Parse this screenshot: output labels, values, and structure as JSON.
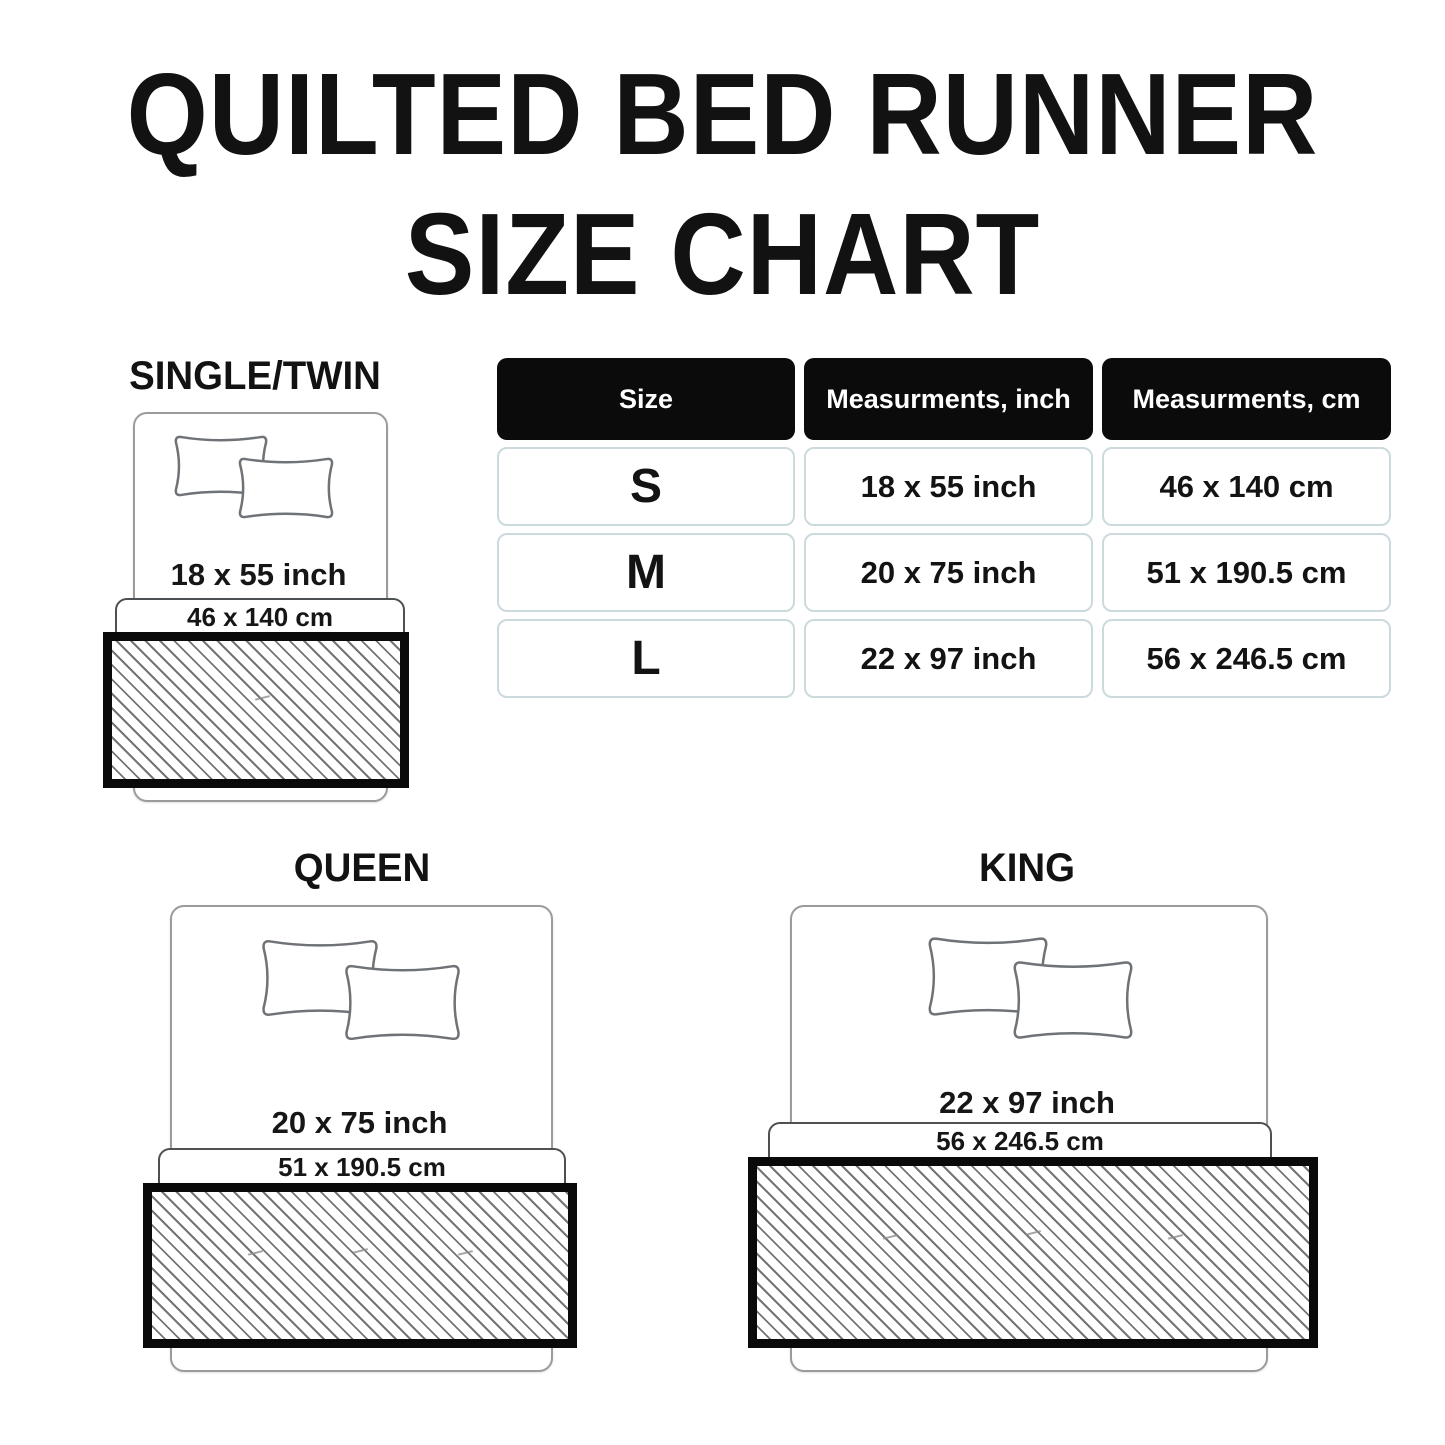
{
  "title": {
    "line1": "QUILTED BED RUNNER",
    "line2": "SIZE CHART"
  },
  "table": {
    "headers": [
      "Size",
      "Measurments, inch",
      "Measurments, cm"
    ],
    "rows": [
      {
        "size": "S",
        "inch": "18 x 55 inch",
        "cm": "46 x 140 cm"
      },
      {
        "size": "M",
        "inch": "20 x 75 inch",
        "cm": "51 x 190.5 cm"
      },
      {
        "size": "L",
        "inch": "22 x 97 inch",
        "cm": "56 x 246.5 cm"
      }
    ]
  },
  "diagrams": [
    {
      "label": "SINGLE/TWIN",
      "inch": "18 x 55 inch",
      "cm": "46 x 140 cm"
    },
    {
      "label": "QUEEN",
      "inch": "20 x 75 inch",
      "cm": "51 x 190.5 cm"
    },
    {
      "label": "KING",
      "inch": "22 x 97 inch",
      "cm": "56 x 246.5 cm"
    }
  ],
  "colors": {
    "header_bg": "#0b0b0b",
    "cell_border": "#ccdadd",
    "runner_border": "#0a0a0a",
    "hatch_line": "#757575",
    "bed_outline": "#9b9b9b",
    "pillow_outline": "#6f7276",
    "strip_outline": "#4d5154"
  }
}
